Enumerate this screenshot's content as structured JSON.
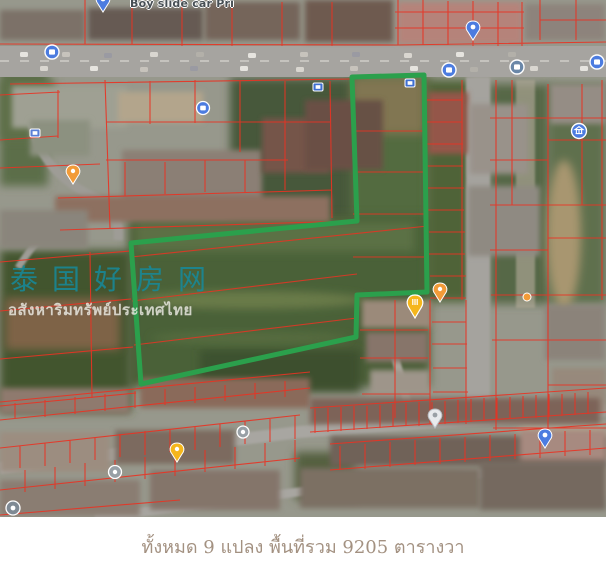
{
  "map": {
    "poi_labels": {
      "top_left": "Boy slide car Pri"
    },
    "watermark": {
      "line1": "泰国好房网",
      "line2": "อสังหาริมทรัพย์ประเทศไทย",
      "line1_color": "#178998",
      "line2_color": "#f4f2ea"
    },
    "plot": {
      "outline_points": "352,77 424,75 427,292 357,295 356,337 141,384 131,243 357,221",
      "outline_color": "#2ba04c"
    },
    "colors": {
      "cadastral_lines": "#e93323",
      "road": "#a6a4a0",
      "restaurant_pin": "#f5b61c",
      "poi_blue": "#4c7ce0",
      "poi_gray": "#98a0a6",
      "orange_pin": "#f29b38"
    },
    "icon_names": [
      "map-pin-icon",
      "store-poi-icon",
      "government-poi-icon",
      "restaurant-pin-icon",
      "transit-stop-icon"
    ]
  },
  "caption": {
    "text": "ทั้งหมด 9 แปลง พื้นที่รวม 9205 ตารางวา",
    "color": "#a39181"
  }
}
